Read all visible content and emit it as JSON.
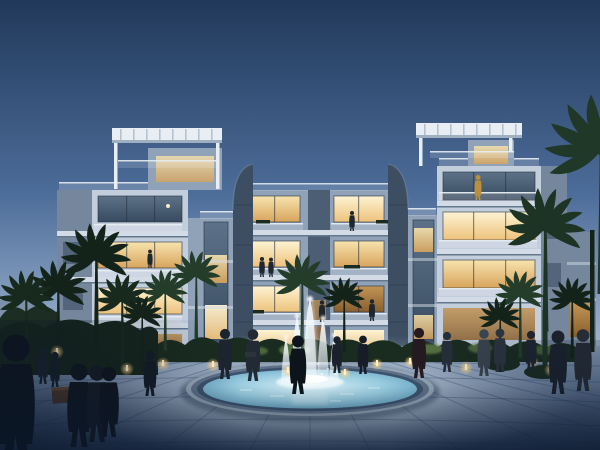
{
  "scene": {
    "type": "architectural-rendering",
    "description": "Twilight rendering of a modern four-storey residential complex with lit balconies, rooftop pergolas on two end towers, dark curved fin walls, palm trees, a circular fountain with five water jets, amber bollard path lights and people strolling on a paved plaza",
    "time_of_day": "dusk",
    "building_floors": 4,
    "towers": 2,
    "fountain": {
      "shape": "circular",
      "jet_count": 5
    }
  },
  "colors": {
    "sky_top": "#21395a",
    "sky_mid": "#4c6c99",
    "sky_low": "#8ea6c4",
    "sky_horizon": "#b7c3d7",
    "wall_light": "#c2cedc",
    "wall_mid": "#8fa2b8",
    "wall_shadow": "#75879d",
    "slab_light": "#d3dce6",
    "slab_shadow": "#64788d",
    "fin_dark": "#3d4e62",
    "roof_white": "#e9eef4",
    "rail_white": "#e8edf2",
    "frame_dark": "#26303d",
    "window_warm_hi": "#f7e3ae",
    "window_warm_lo": "#d8a45c",
    "window_bright_hi": "#fdf3d3",
    "window_bright_lo": "#eec27c",
    "window_deep_hi": "#c29455",
    "window_deep_lo": "#8a5f2e",
    "window_cool_hi": "#5d7288",
    "window_cool_lo": "#374a5f",
    "palm_dark": "#14231a",
    "palm_mid": "#243d2a",
    "palm_light": "#31502f",
    "bush_dark": "#1a2b1f",
    "bush_lit": "#62804a",
    "treeline": "#1c2d23",
    "planter_brown": "#53392a",
    "plaza_light": "#d6e1ea",
    "plaza_mid": "#8ba1bb",
    "plaza_dark": "#31476b",
    "water_light": "#d8eef6",
    "water_mid": "#99ccdf",
    "water_deep": "#5e9cbd",
    "basin_rim_hi": "#93a3b4",
    "basin_rim_md": "#5d7088",
    "basin_rim_lo": "#3c516b",
    "jet_white": "#f2f9fc",
    "light_amber": "#ffd27e",
    "light_amber_core": "#fff0c8",
    "person_dark": "#141b26",
    "shade": "#0a1628"
  }
}
